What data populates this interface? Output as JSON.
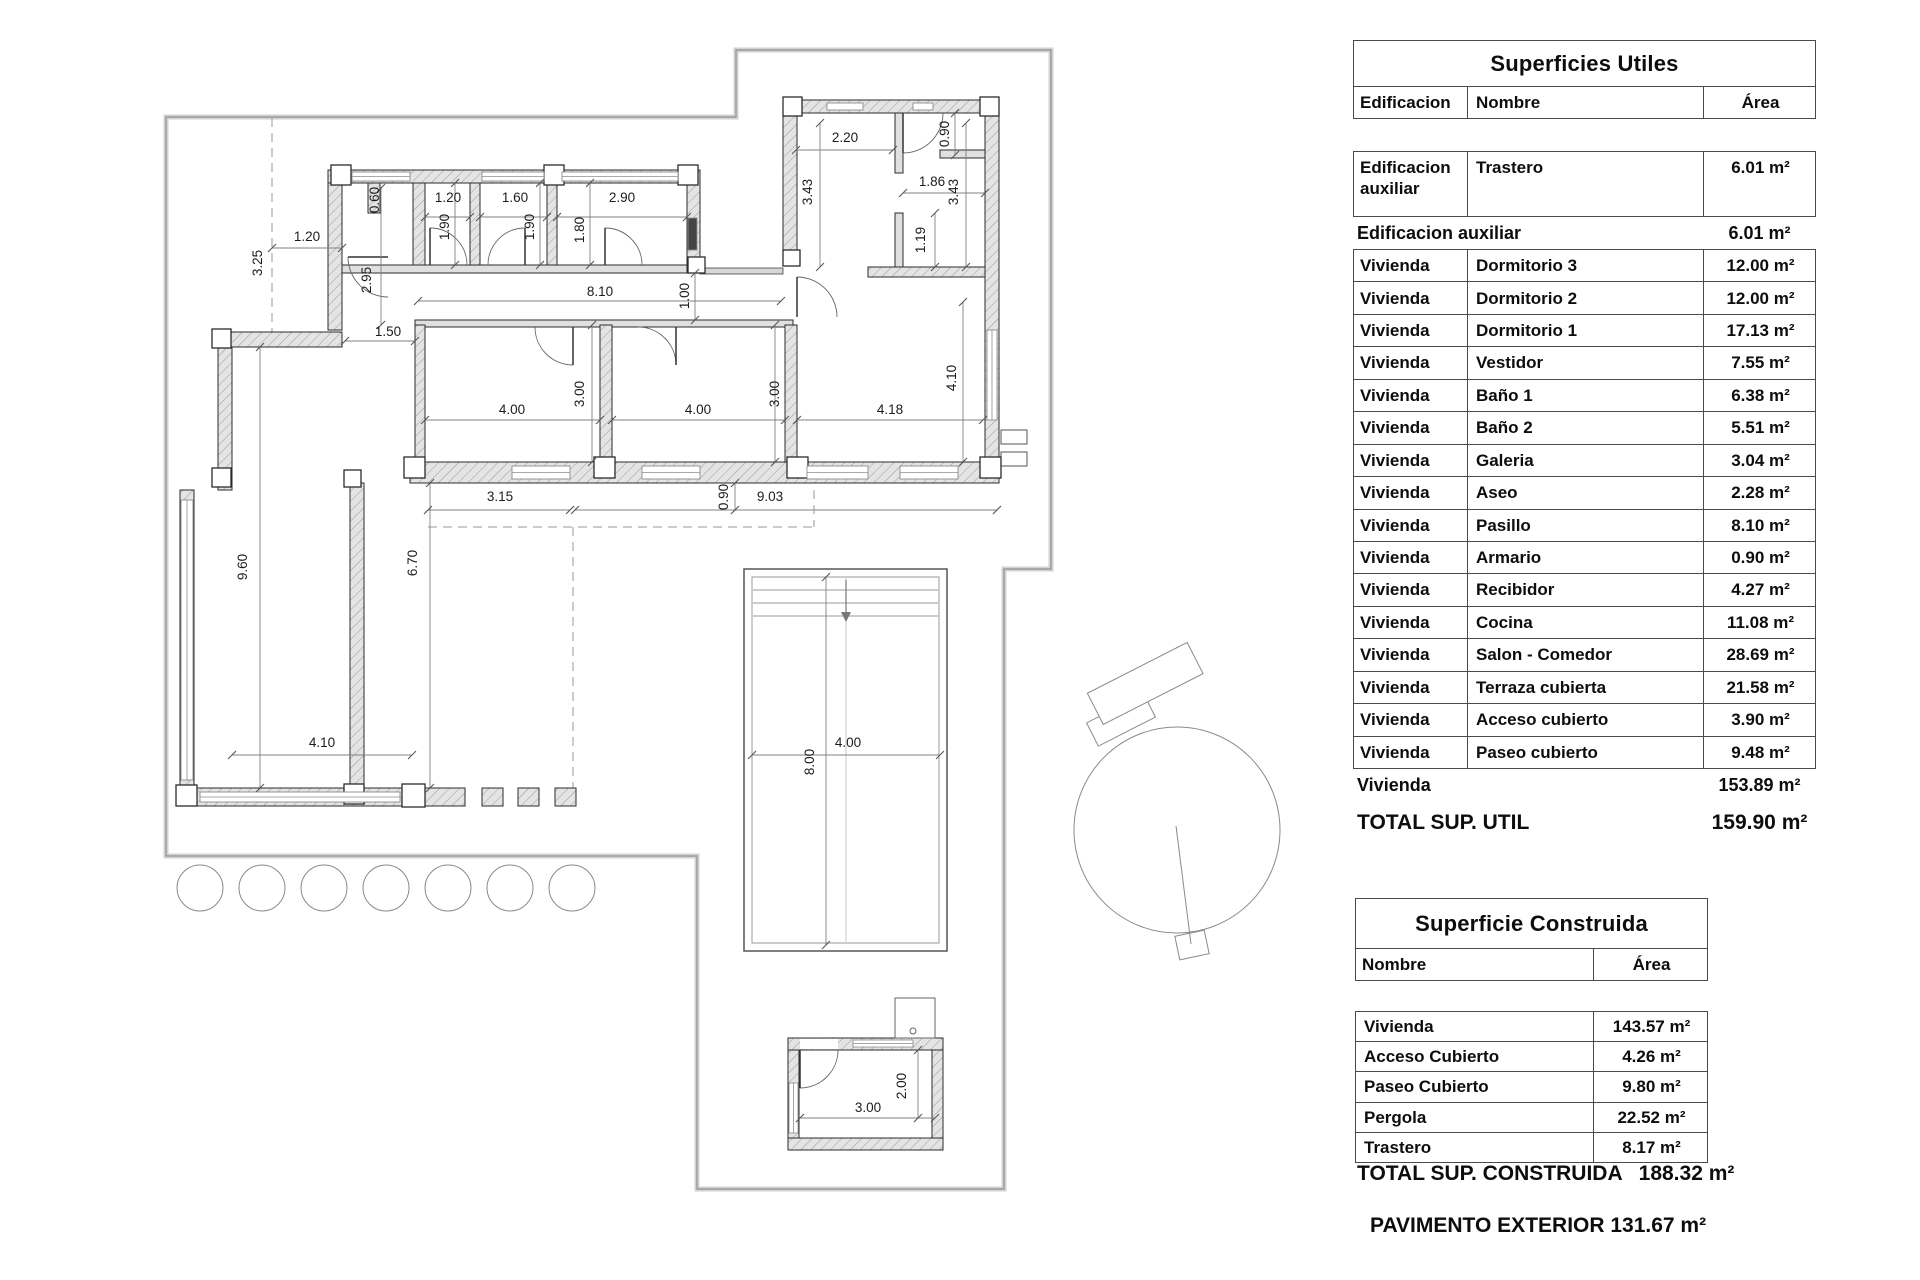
{
  "plan": {
    "dim_labels": [
      {
        "t": "1.20",
        "x": 307,
        "y": 241,
        "r": 0
      },
      {
        "t": "3.25",
        "x": 262,
        "y": 263,
        "r": -90
      },
      {
        "t": "0.60",
        "x": 379,
        "y": 200,
        "r": -90
      },
      {
        "t": "2.95",
        "x": 371,
        "y": 280,
        "r": -90
      },
      {
        "t": "1.50",
        "x": 388,
        "y": 336,
        "r": 0
      },
      {
        "t": "1.20",
        "x": 448,
        "y": 202,
        "r": 0
      },
      {
        "t": "1.60",
        "x": 515,
        "y": 202,
        "r": 0
      },
      {
        "t": "2.90",
        "x": 622,
        "y": 202,
        "r": 0
      },
      {
        "t": "1.90",
        "x": 449,
        "y": 227,
        "r": -90
      },
      {
        "t": "1.90",
        "x": 534,
        "y": 227,
        "r": -90
      },
      {
        "t": "1.80",
        "x": 584,
        "y": 230,
        "r": -90
      },
      {
        "t": "8.10",
        "x": 600,
        "y": 296,
        "r": 0
      },
      {
        "t": "1.00",
        "x": 689,
        "y": 296,
        "r": -90
      },
      {
        "t": "2.20",
        "x": 845,
        "y": 142,
        "r": 0
      },
      {
        "t": "0.90",
        "x": 949,
        "y": 134,
        "r": -90
      },
      {
        "t": "3.43",
        "x": 812,
        "y": 192,
        "r": -90
      },
      {
        "t": "1.86",
        "x": 932,
        "y": 186,
        "r": 0
      },
      {
        "t": "3.43",
        "x": 958,
        "y": 192,
        "r": -90
      },
      {
        "t": "1.19",
        "x": 925,
        "y": 240,
        "r": -90
      },
      {
        "t": "4.10",
        "x": 956,
        "y": 378,
        "r": -90
      },
      {
        "t": "4.00",
        "x": 512,
        "y": 414,
        "r": 0
      },
      {
        "t": "3.00",
        "x": 584,
        "y": 394,
        "r": -90
      },
      {
        "t": "4.00",
        "x": 698,
        "y": 414,
        "r": 0
      },
      {
        "t": "3.00",
        "x": 779,
        "y": 394,
        "r": -90
      },
      {
        "t": "4.18",
        "x": 890,
        "y": 414,
        "r": 0
      },
      {
        "t": "3.15",
        "x": 500,
        "y": 501,
        "r": 0
      },
      {
        "t": "0.90",
        "x": 728,
        "y": 497,
        "r": -90
      },
      {
        "t": "9.03",
        "x": 770,
        "y": 501,
        "r": 0
      },
      {
        "t": "9.60",
        "x": 247,
        "y": 567,
        "r": -90
      },
      {
        "t": "6.70",
        "x": 417,
        "y": 563,
        "r": -90
      },
      {
        "t": "4.10",
        "x": 322,
        "y": 747,
        "r": 0
      },
      {
        "t": "8.00",
        "x": 814,
        "y": 762,
        "r": -90
      },
      {
        "t": "4.00",
        "x": 848,
        "y": 747,
        "r": 0
      },
      {
        "t": "3.00",
        "x": 868,
        "y": 1112,
        "r": 0
      },
      {
        "t": "2.00",
        "x": 906,
        "y": 1086,
        "r": -90
      }
    ]
  },
  "tables": {
    "utiles": {
      "title": "Superficies Utiles",
      "columns": {
        "edificacion": "Edificacion",
        "nombre": "Nombre",
        "area": "Área"
      },
      "first_row": {
        "edificacion": "Edificacion auxiliar",
        "nombre": "Trastero",
        "area": "6.01 m²"
      },
      "subtotal_aux": {
        "label": "Edificacion auxiliar",
        "value": "6.01 m²"
      },
      "rows": [
        {
          "edificacion": "Vivienda",
          "nombre": "Dormitorio 3",
          "area": "12.00 m²"
        },
        {
          "edificacion": "Vivienda",
          "nombre": "Dormitorio 2",
          "area": "12.00 m²"
        },
        {
          "edificacion": "Vivienda",
          "nombre": "Dormitorio 1",
          "area": "17.13 m²"
        },
        {
          "edificacion": "Vivienda",
          "nombre": "Vestidor",
          "area": "7.55 m²"
        },
        {
          "edificacion": "Vivienda",
          "nombre": "Baño 1",
          "area": "6.38 m²"
        },
        {
          "edificacion": "Vivienda",
          "nombre": "Baño 2",
          "area": "5.51 m²"
        },
        {
          "edificacion": "Vivienda",
          "nombre": "Galeria",
          "area": "3.04 m²"
        },
        {
          "edificacion": "Vivienda",
          "nombre": "Aseo",
          "area": "2.28 m²"
        },
        {
          "edificacion": "Vivienda",
          "nombre": "Pasillo",
          "area": "8.10 m²"
        },
        {
          "edificacion": "Vivienda",
          "nombre": "Armario",
          "area": "0.90 m²"
        },
        {
          "edificacion": "Vivienda",
          "nombre": "Recibidor",
          "area": "4.27 m²"
        },
        {
          "edificacion": "Vivienda",
          "nombre": "Cocina",
          "area": "11.08 m²"
        },
        {
          "edificacion": "Vivienda",
          "nombre": "Salon - Comedor",
          "area": "28.69 m²"
        },
        {
          "edificacion": "Vivienda",
          "nombre": "Terraza cubierta",
          "area": "21.58 m²"
        },
        {
          "edificacion": "Vivienda",
          "nombre": "Acceso cubierto",
          "area": "3.90 m²"
        },
        {
          "edificacion": "Vivienda",
          "nombre": "Paseo cubierto",
          "area": "9.48 m²"
        }
      ],
      "subtotal_viv": {
        "label": "Vivienda",
        "value": "153.89 m²"
      },
      "total": {
        "label": "TOTAL SUP. UTIL",
        "value": "159.90 m²"
      }
    },
    "construida": {
      "title": "Superficie Construida",
      "columns": {
        "nombre": "Nombre",
        "area": "Área"
      },
      "rows": [
        {
          "nombre": "Vivienda",
          "area": "143.57 m²"
        },
        {
          "nombre": "Acceso Cubierto",
          "area": "4.26 m²"
        },
        {
          "nombre": "Paseo Cubierto",
          "area": "9.80 m²"
        },
        {
          "nombre": "Pergola",
          "area": "22.52 m²"
        },
        {
          "nombre": "Trastero",
          "area": "8.17 m²"
        }
      ],
      "total": {
        "label": "TOTAL SUP. CONSTRUIDA",
        "value": "188.32 m²"
      }
    }
  },
  "footer": {
    "pavimento": "PAVIMENTO EXTERIOR 131.67 m²"
  }
}
